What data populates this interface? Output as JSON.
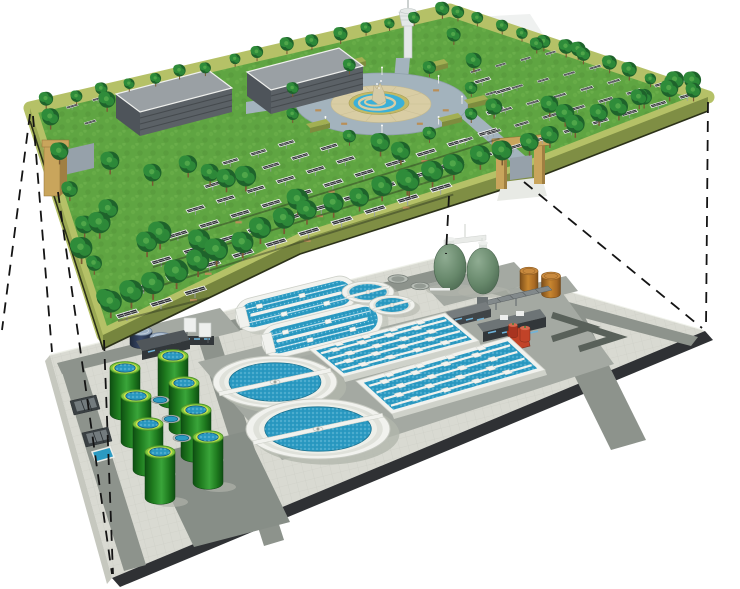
{
  "canvas": {
    "width": 740,
    "height": 589,
    "background": "#ffffff"
  },
  "scene": {
    "type": "isometric-cutaway-illustration",
    "upper_layer": {
      "name": "solar-panel-park",
      "solar_panel_rows": 14,
      "trees_approx": 90,
      "service_buildings": 2,
      "entrance_gates": 2,
      "central_fountain_plaza": 1,
      "observation_tower": 1,
      "plaza_hedges": 6
    },
    "lower_layer": {
      "name": "underground-wastewater-treatment-plant",
      "circular_clarifiers": 2,
      "oxidation_ditches": 2,
      "aeration_basins": 2,
      "aeration_basin_lanes": 5,
      "small_clarifiers": 2,
      "covered_small_tanks": 2,
      "green_digester_tanks": 8,
      "egg_digesters": 2,
      "orange_storage_tanks": 2,
      "red_pump_station": 1,
      "plant_buildings": 4,
      "intake_screens": 2,
      "manhole_covers": 3,
      "road_chevrons": 2
    },
    "projection_lines": {
      "style": "dashed",
      "count": 7
    }
  },
  "colors": {
    "background": "#ffffff",
    "grass": "#5fa542",
    "grass2": "#6fb24c",
    "grass3": "#549539",
    "grass4": "#7fbf5a",
    "park_border": "#b5c167",
    "park_side": "#7f8e44",
    "park_side2": "#76853e",
    "park_side_left": "#9aa853",
    "park_edge_line": "#2b3118",
    "tree_dark": "#1e632b",
    "tree_mid": "#2f8c3a",
    "tree_light": "#57ad4e",
    "trunk": "#7a5a33",
    "panel_dark": "#2e3134",
    "panel_frame": "#f3f4f4",
    "post_gray": "#9aa0a3",
    "trench": "#2a331f",
    "bench": "#b98f58",
    "building_roof": "#9aa0a4",
    "building_face": "#5b6166",
    "building_end": "#4e545a",
    "building_rib": "#454a4e",
    "plaza_ring": "#a3b3bd",
    "plaza_tan": "#d9cda4",
    "fountain_rim": "#c2ba66",
    "fountain_blue": "#3bb0d8",
    "fountain_rock": "#d5cba8",
    "hedge_top": "#a2af52",
    "hedge_side": "#7e8c3e",
    "gate_tan": "#c9a55c",
    "gate_shade": "#a07f42",
    "gate_wall": "#96a1aa",
    "tower": "#e4e8e7",
    "tower_shade": "#b9c1c0",
    "ghost": "#eff1f0",
    "dash": "#141414",
    "platform": "#d9dad2",
    "platform_edge": "#2f3134",
    "platform_face": "#c6c8bf",
    "tile": "#b9bcb2",
    "road": "#8d938c",
    "apron": "#a4a9a2",
    "pad_dark": "#878e87",
    "chevron": "#59615a",
    "white_struct": "#f1f2ee",
    "concrete": "#dfe1da",
    "wall_lip": "#cfd2ca",
    "water": "#2b9ac2",
    "water_dot_l": "#bfe9f6",
    "water_dot_d": "#1d7fa6",
    "shadow": "#b2b6ac",
    "tank_rim": "#7ec83e",
    "tank_ring": "#cfe14a",
    "navy_top": "#9db0c5",
    "egg_l": "#8fac92",
    "egg": "#66876a",
    "egg_d": "#415c47",
    "orange_l": "#c8862f",
    "orange_d": "#7c4e1a",
    "orange_top": "#c98a3e",
    "red": "#c14328",
    "red_d": "#7d2a18",
    "dark_b": "#3f4447",
    "dark_b2": "#32373a",
    "win": "#6fb3d9"
  }
}
